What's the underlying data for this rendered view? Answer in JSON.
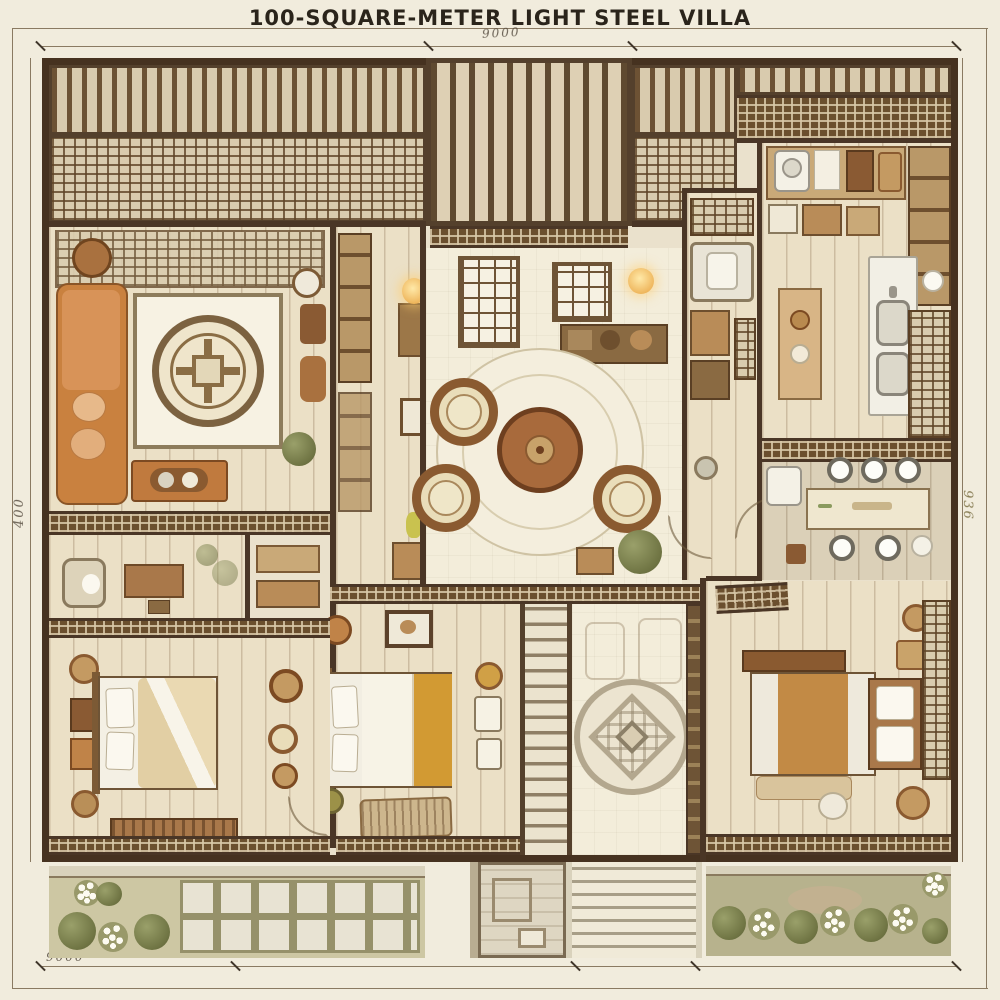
{
  "title": "100-SQUARE-METER LIGHT STEEL VILLA",
  "annotations": {
    "top_note": "9000",
    "left_dim": "400",
    "right_dim": "936",
    "bottom_left_note": "9000",
    "bottom_center_note": "40"
  },
  "palette": {
    "paper": "#f1ecdd",
    "wall_dark": "#4a3626",
    "timber": "#6d5234",
    "lattice_cream": "#d9ccae",
    "floor_wood": "#ebe0c6",
    "sofa_orange": "#c9813f",
    "duvet_amber": "#d39a38",
    "bed_caramel": "#c08a47",
    "garden_olive": "#7d8049",
    "paver_light": "#e8e3d3"
  }
}
